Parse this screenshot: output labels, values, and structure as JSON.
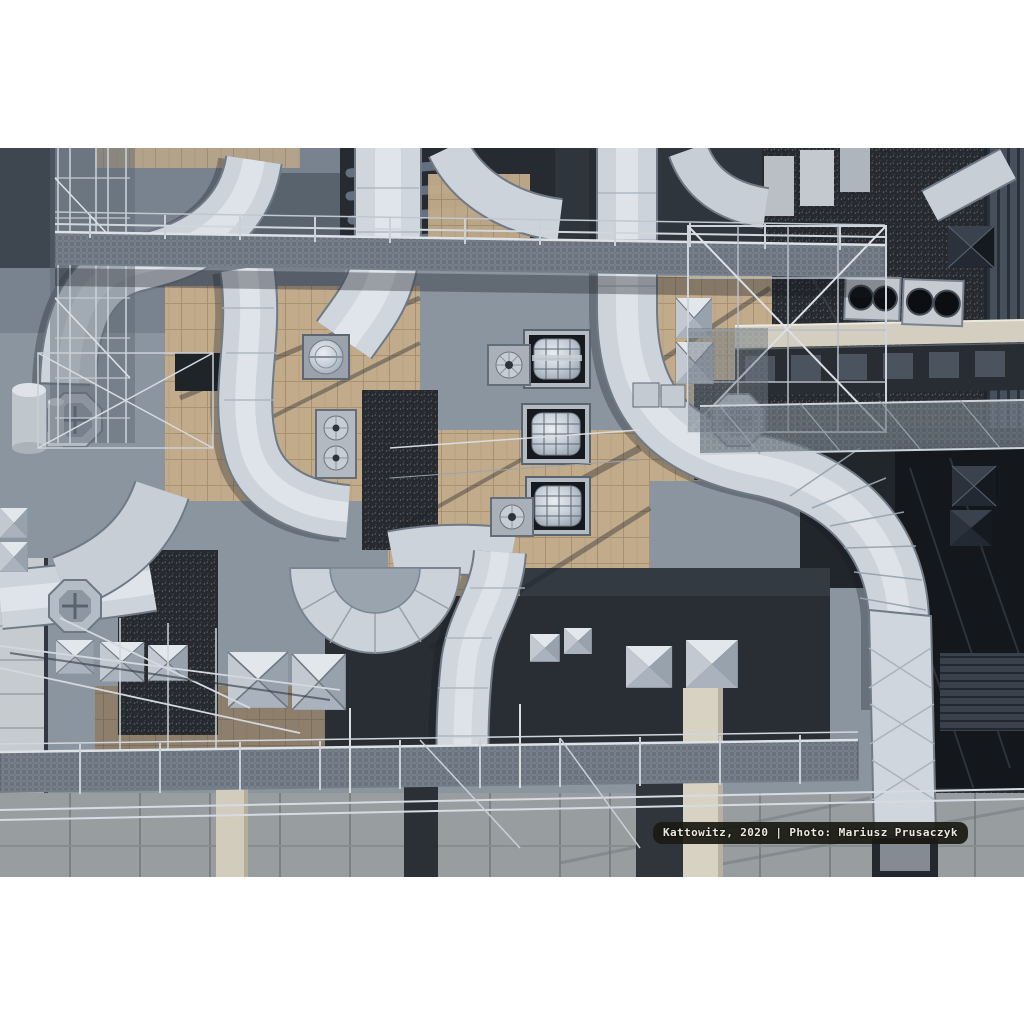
{
  "page": {
    "background_color": "#ffffff"
  },
  "photo": {
    "caption": "Kattowitz, 2020 | Photo: Mariusz Prusaczyk",
    "description": "Top-down aerial photograph of a building rooftop densely packed with silver HVAC ductwork, elbow ducts, pyramid and dome skylights, steel mesh catwalks, scaffolding, fan units, tan paver walkways, dark gravel roof areas and concrete parapets.",
    "palette": {
      "duct_silver": "#ccd3da",
      "duct_highlight": "#e3e8ed",
      "steel_blue_gray": "#8b95a0",
      "roof_charcoal": "#292e34",
      "gravel_dark": "#26292d",
      "paver_tan": "#c2ab8a",
      "walkway_pale": "#d3cebf",
      "rail_light": "#d8dde2",
      "caption_background": "#1a1b12",
      "caption_text": "#ece8dd"
    }
  }
}
